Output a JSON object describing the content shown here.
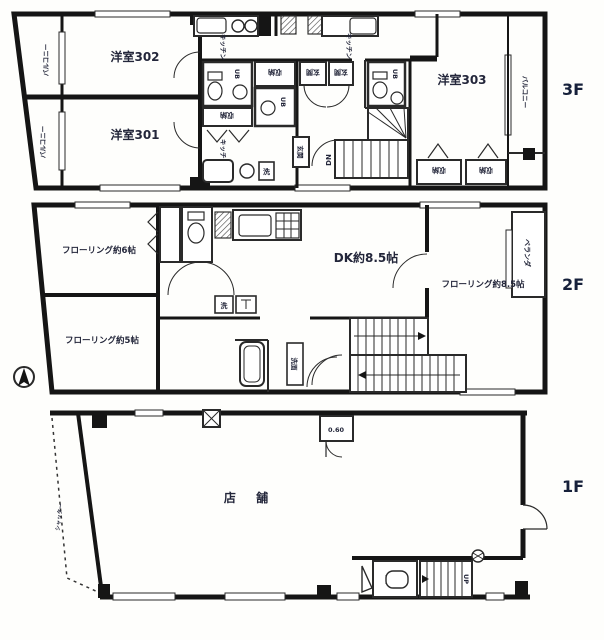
{
  "title": "建物平面図",
  "floors": {
    "f3": {
      "tag": "3F",
      "labels": {
        "room302": "洋室302",
        "room301": "洋室301",
        "room303": "洋室303",
        "balcony_left_top": "バルコニー",
        "balcony_left_bottom": "バルコニー",
        "balcony_right": "バルコニー",
        "ub1": "UB",
        "ub2": "UB",
        "ub3": "UB",
        "storage1": "収納",
        "storage2": "収納",
        "storage3": "収納",
        "storage4": "収納",
        "genkan1": "玄関",
        "genkan2": "玄関",
        "genkan3": "玄関",
        "kitchen1": "キッチン",
        "kitchen2": "キッチン",
        "kitchen3": "キッチン",
        "laundry1": "洗",
        "dn": "DN"
      }
    },
    "f2": {
      "tag": "2F",
      "labels": {
        "flooring6": "フローリング約6帖",
        "flooring5": "フローリング約5帖",
        "dk": "DK約8.5帖",
        "flooring85": "フローリング約8.5帖",
        "veranda": "ベランダ",
        "laundry": "洗",
        "senmen": "洗面"
      }
    },
    "f1": {
      "tag": "1F",
      "labels": {
        "shop": "店 舗",
        "shutter": "シャッター",
        "up": "UP",
        "utility": "0.60"
      }
    }
  }
}
